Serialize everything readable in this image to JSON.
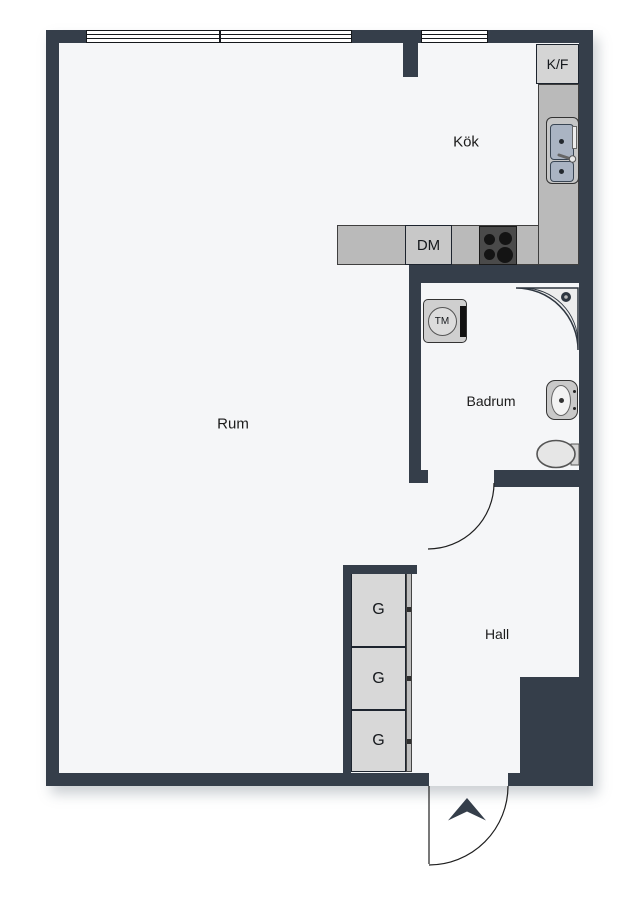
{
  "plan": {
    "rooms": {
      "room": {
        "label": "Rum"
      },
      "kitchen": {
        "label": "Kök"
      },
      "bathroom": {
        "label": "Badrum"
      },
      "hall": {
        "label": "Hall"
      }
    },
    "fixtures": {
      "fridge_freezer": {
        "label": "K/F"
      },
      "dishwasher": {
        "label": "DM"
      },
      "washing_machine": {
        "label": "TM"
      },
      "wardrobes": [
        {
          "label": "G"
        },
        {
          "label": "G"
        },
        {
          "label": "G"
        }
      ]
    },
    "colors": {
      "wall": "#353E4A",
      "floor": "#F5F6F8",
      "counter": "#BABABA",
      "appliance_box": "#D5D5D5",
      "stove": "#4A4A4A",
      "sink_basin": "#AAB4C3"
    }
  }
}
